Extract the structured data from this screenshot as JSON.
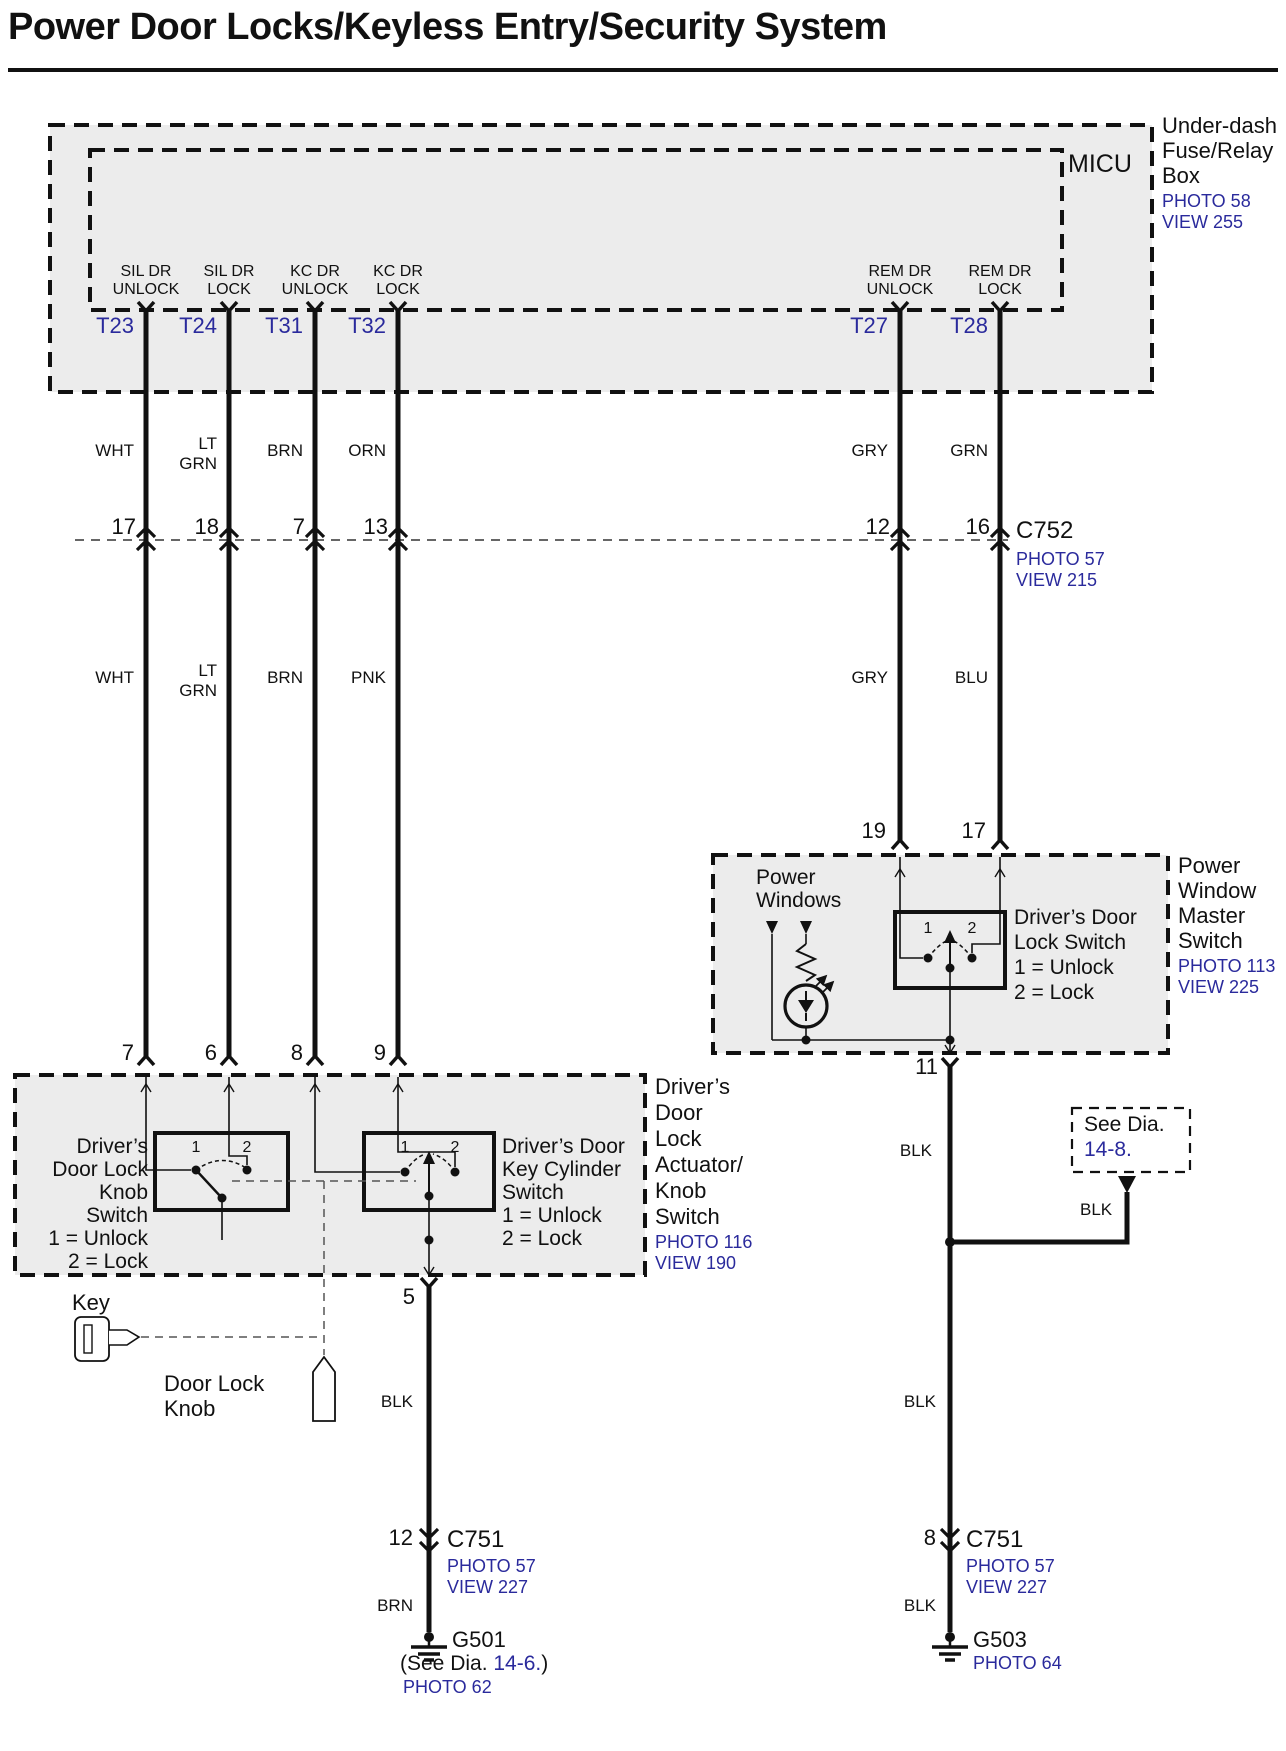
{
  "title": "Power Door Locks/Keyless Entry/Security System",
  "accent_colors": {
    "link_blue": "#2a2a9c",
    "line_black": "#111111",
    "box_gray": "#ececec"
  },
  "fuse_box": {
    "unit": "MICU",
    "label": [
      "Under-dash",
      "Fuse/Relay",
      "Box"
    ],
    "photo": "PHOTO 58",
    "view": "VIEW 255",
    "terminals": [
      {
        "id": "T23",
        "l1": "SIL DR",
        "l2": "UNLOCK"
      },
      {
        "id": "T24",
        "l1": "SIL DR",
        "l2": "LOCK"
      },
      {
        "id": "T31",
        "l1": "KC DR",
        "l2": "UNLOCK"
      },
      {
        "id": "T32",
        "l1": "KC DR",
        "l2": "LOCK"
      },
      {
        "id": "T27",
        "l1": "REM DR",
        "l2": "UNLOCK"
      },
      {
        "id": "T28",
        "l1": "REM DR",
        "l2": "LOCK"
      }
    ]
  },
  "c752": {
    "name": "C752",
    "photo": "PHOTO 57",
    "view": "VIEW 215",
    "pins": [
      "17",
      "18",
      "7",
      "13",
      "12",
      "16"
    ]
  },
  "wire_colors_upper": [
    {
      "l1": "WHT"
    },
    {
      "l1": "LT",
      "l2": "GRN"
    },
    {
      "l1": "BRN"
    },
    {
      "l1": "ORN"
    },
    {
      "l1": "GRY"
    },
    {
      "l1": "GRN"
    }
  ],
  "wire_colors_lower": [
    {
      "l1": "WHT"
    },
    {
      "l1": "LT",
      "l2": "GRN"
    },
    {
      "l1": "BRN"
    },
    {
      "l1": "PNK"
    },
    {
      "l1": "GRY"
    },
    {
      "l1": "BLU"
    }
  ],
  "pwms": {
    "pins": [
      "19",
      "17"
    ],
    "out_pin": "11",
    "label": [
      "Power",
      "Window",
      "Master",
      "Switch"
    ],
    "photo": "PHOTO 113",
    "view": "VIEW 225",
    "power_windows": [
      "Power",
      "Windows"
    ],
    "switch": {
      "title": [
        "Driver’s Door",
        "Lock Switch",
        "1 = Unlock",
        "2 = Lock"
      ],
      "pos1": "1",
      "pos2": "2"
    }
  },
  "actuator": {
    "pins": [
      "7",
      "6",
      "8",
      "9"
    ],
    "out_pin": "5",
    "label": [
      "Driver’s",
      "Door",
      "Lock",
      "Actuator/",
      "Knob",
      "Switch"
    ],
    "photo": "PHOTO 116",
    "view": "VIEW 190",
    "knob_switch": {
      "title": [
        "Driver’s",
        "Door Lock",
        "Knob",
        "Switch",
        "1 = Unlock",
        "2 = Lock"
      ],
      "pos1": "1",
      "pos2": "2"
    },
    "key_switch": {
      "title": [
        "Driver’s Door",
        "Key Cylinder",
        "Switch",
        "1 = Unlock",
        "2 = Lock"
      ],
      "pos1": "1",
      "pos2": "2"
    },
    "key_label": "Key",
    "knob_label": [
      "Door Lock",
      "Knob"
    ]
  },
  "see_dia_box": {
    "line1": "See Dia.",
    "line2": "14-8."
  },
  "right_branch": {
    "blk_upper": "BLK",
    "blk_branch": "BLK"
  },
  "ground_left": {
    "wire_above": "BLK",
    "pin": "12",
    "connector": "C751",
    "photo": "PHOTO 57",
    "view": "VIEW 227",
    "wire_below": "BRN",
    "name": "G501",
    "note_pre": "(See Dia. ",
    "note_link": "14-6.",
    "note_post": ")",
    "photo2": "PHOTO 62"
  },
  "ground_right": {
    "wire_above": "BLK",
    "pin": "8",
    "connector": "C751",
    "photo": "PHOTO 57",
    "view": "VIEW 227",
    "wire_below": "BLK",
    "name": "G503",
    "photo2": "PHOTO 64"
  }
}
